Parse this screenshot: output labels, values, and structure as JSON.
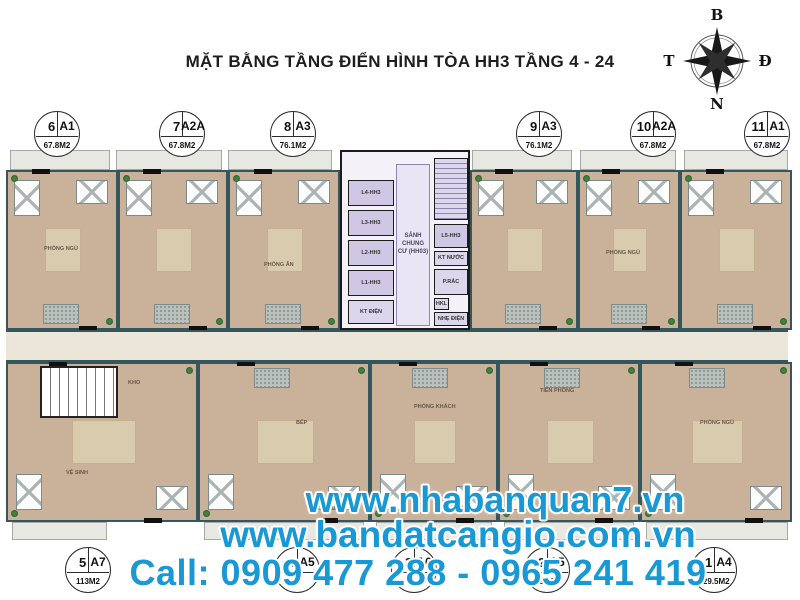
{
  "title": "MẶT BẰNG TẦNG ĐIỂN HÌNH TÒA HH3 TẦNG 4 - 24",
  "compass": {
    "north_label": "B",
    "east_label": "Đ",
    "west_label": "T",
    "south_label": "N"
  },
  "top_units": [
    {
      "number": "6",
      "type": "A1",
      "area": "67.8M2"
    },
    {
      "number": "7",
      "type": "A2A",
      "area": "67.8M2"
    },
    {
      "number": "8",
      "type": "A3",
      "area": "76.1M2"
    },
    {
      "number": "9",
      "type": "A3",
      "area": "76.1M2"
    },
    {
      "number": "10",
      "type": "A2A",
      "area": "67.8M2"
    },
    {
      "number": "11",
      "type": "A1",
      "area": "67.8M2"
    }
  ],
  "bottom_units": [
    {
      "number": "5",
      "type": "A7",
      "area": "113M2"
    },
    {
      "number": "4",
      "type": "A5",
      "area": ""
    },
    {
      "number": "3",
      "type": "A6",
      "area": ""
    },
    {
      "number": "2",
      "type": "A5",
      "area": "3M2"
    },
    {
      "number": "1",
      "type": "A4",
      "area": "129.5M2"
    }
  ],
  "core": {
    "lobby_label": "SẢNH CHUNG CƯ (HH03)",
    "elevators_left": [
      "L4-HH3",
      "L3-HH3",
      "L2-HH3",
      "L1-HH3"
    ],
    "elevator_right": "L5-HH3",
    "electrical_room": "KT ĐIỆN",
    "water_room": "KT NƯỚC",
    "garbage_room": "P.RÁC",
    "duct": "HKL",
    "low_voltage_room": "NHẸ ĐIỆN"
  },
  "room_labels": {
    "bedroom": "PHÒNG NGỦ",
    "living": "PHÒNG KHÁCH",
    "dining": "PHÒNG ĂN",
    "kitchen": "BẾP",
    "loggia": "LÔ GIA",
    "entry": "TIỀN PHÒNG",
    "bath": "VỆ SINH",
    "storage": "KHO"
  },
  "watermark": {
    "site1": "www.nhabanquan7.vn",
    "site2": "www.bandatcangio.com.vn",
    "phone_line": "Call: 0909 477 288 - 0965 241 419"
  },
  "colors": {
    "watermark_blue": "#1899d6",
    "floor_tan": "#c9b299",
    "core_lavender": "#cfc7e3",
    "corridor_cream": "#ebe6d7",
    "wall_dark": "#35565c",
    "tile_gray": "#bac1bd",
    "balcony_gray": "#e8e8e3"
  }
}
